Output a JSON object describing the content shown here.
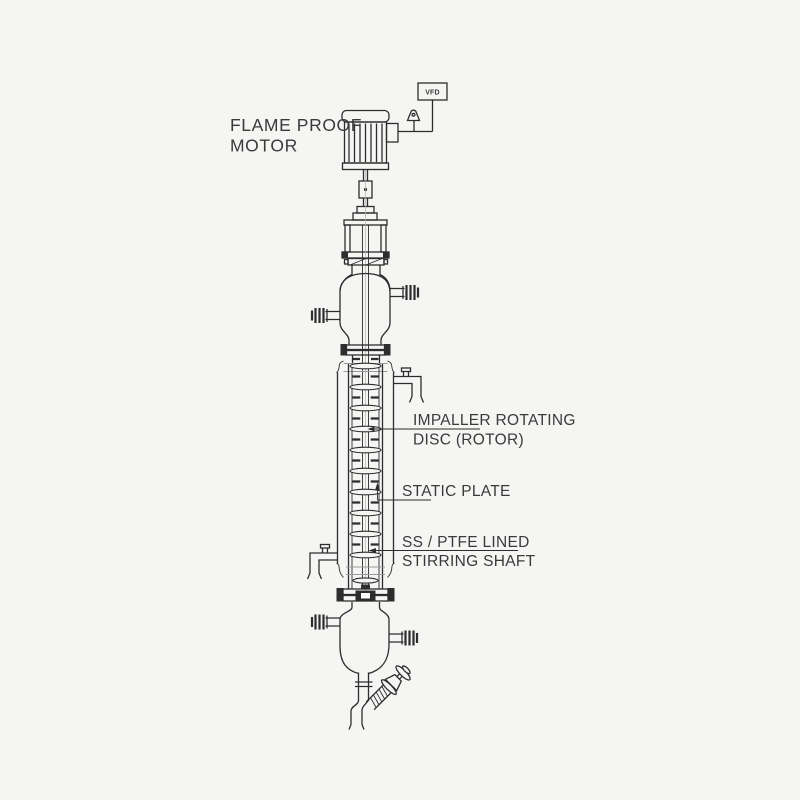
{
  "labels": {
    "motor_line1": "FLAME PROOF",
    "motor_line2": "MOTOR",
    "vfd": "VFD",
    "rotor_line1": "IMPALLER ROTATING",
    "rotor_line2": "DISC (ROTOR)",
    "static_plate": "STATIC PLATE",
    "shaft_line1": "SS / PTFE LINED",
    "shaft_line2": "STIRRING SHAFT"
  },
  "colors": {
    "background": "#f5f5f4",
    "line": "#2d2d2d",
    "line_light": "#9a9a9a",
    "text": "#3a3a3a"
  }
}
